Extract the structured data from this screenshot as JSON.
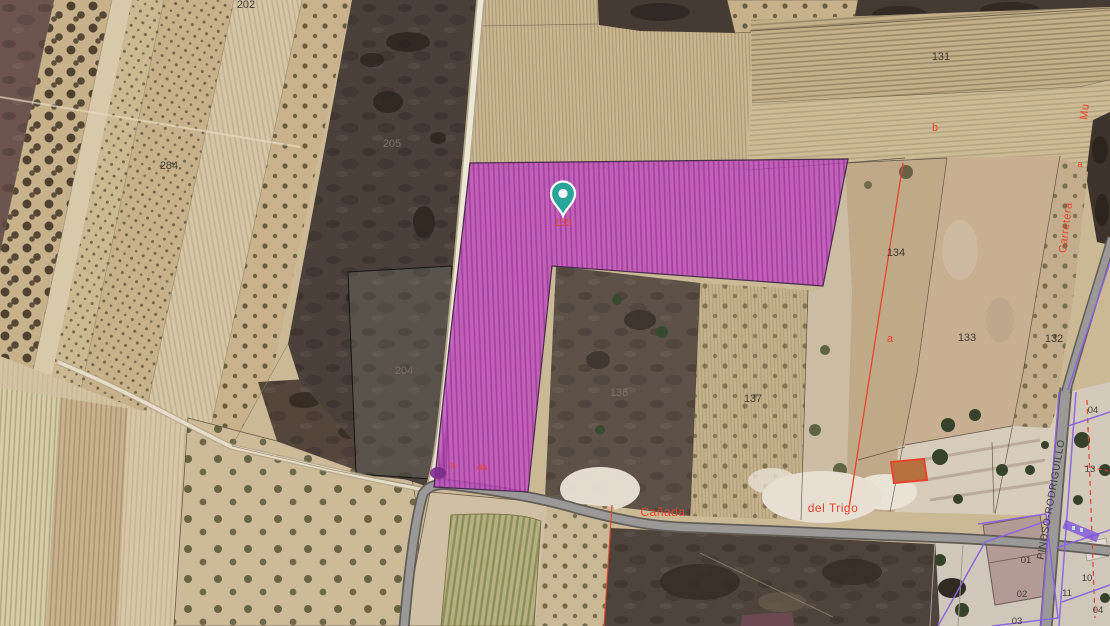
{
  "pin": {
    "icon": "map-pin",
    "color": "#28a598",
    "parcel": "135"
  },
  "highlight": {
    "color": "#bf4ec0"
  },
  "labels": {
    "parcel_numbers": [
      "202",
      "284",
      "205",
      "204",
      "131",
      "134",
      "133",
      "132",
      "136",
      "137"
    ],
    "urban_numbers": [
      "04",
      "13",
      "01",
      "02",
      "03",
      "10",
      "11",
      "04"
    ],
    "red_letters": [
      "b",
      "a",
      "a",
      "da",
      "a"
    ],
    "roads": {
      "canada": "Cañada",
      "del_trigo": "del Trigo",
      "carretera": "Carretera",
      "mu": "Mu",
      "pinoso_rodriguillo": "PINOSO-RODRIGUILLO"
    }
  },
  "colors": {
    "cadastral_red": "#e8432e",
    "cadastral_purple": "#8a63e0",
    "road_grey": "#9b9998",
    "highlight_magenta": "#bf4ec0",
    "pin_teal": "#28a598"
  }
}
